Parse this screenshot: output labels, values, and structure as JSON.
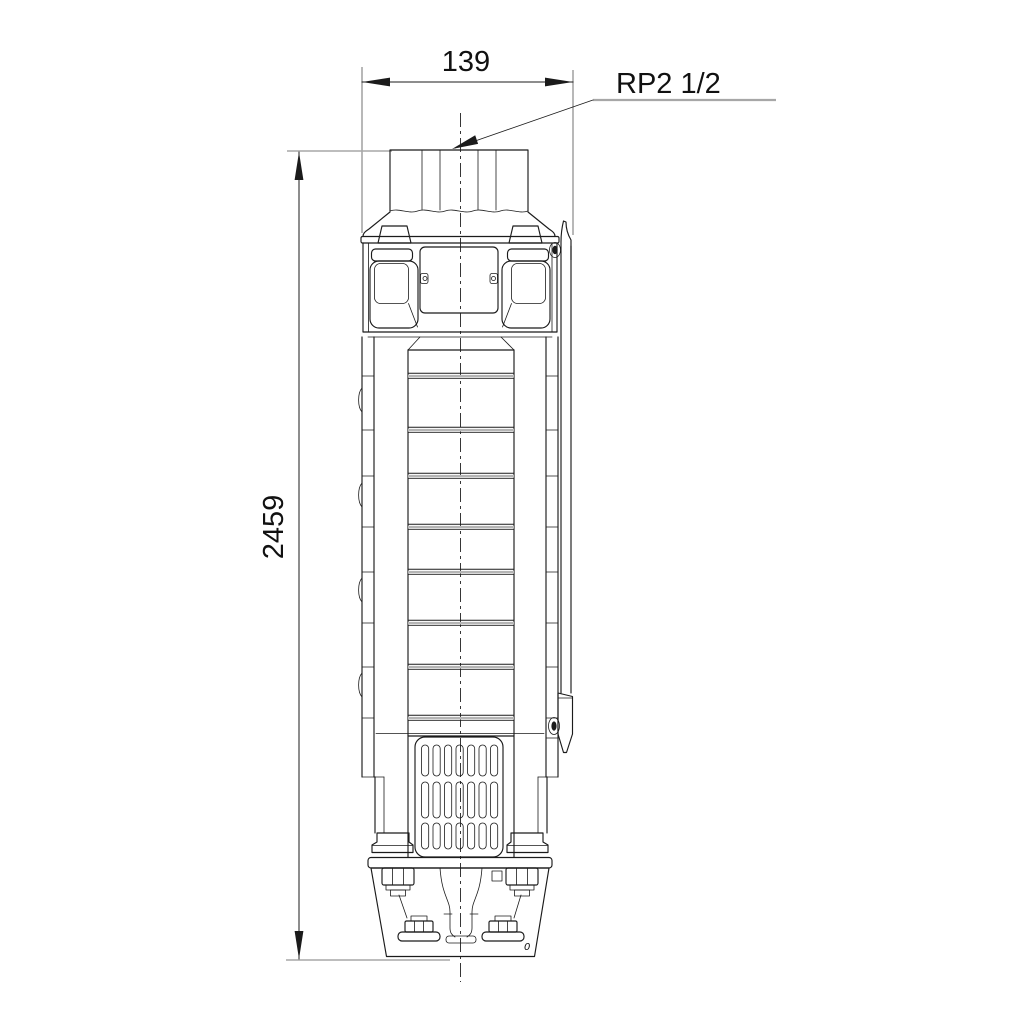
{
  "drawing": {
    "description": "dimensioned technical outline drawing of a vertical pump",
    "labels": {
      "width_mm": "139",
      "height_mm": "2459",
      "connection": "RP2 1/2",
      "stray_mark": "0"
    },
    "colors": {
      "outline": "#1b1b1b",
      "dimension_lines": "#a7a7a7",
      "background": "#ffffff"
    }
  }
}
